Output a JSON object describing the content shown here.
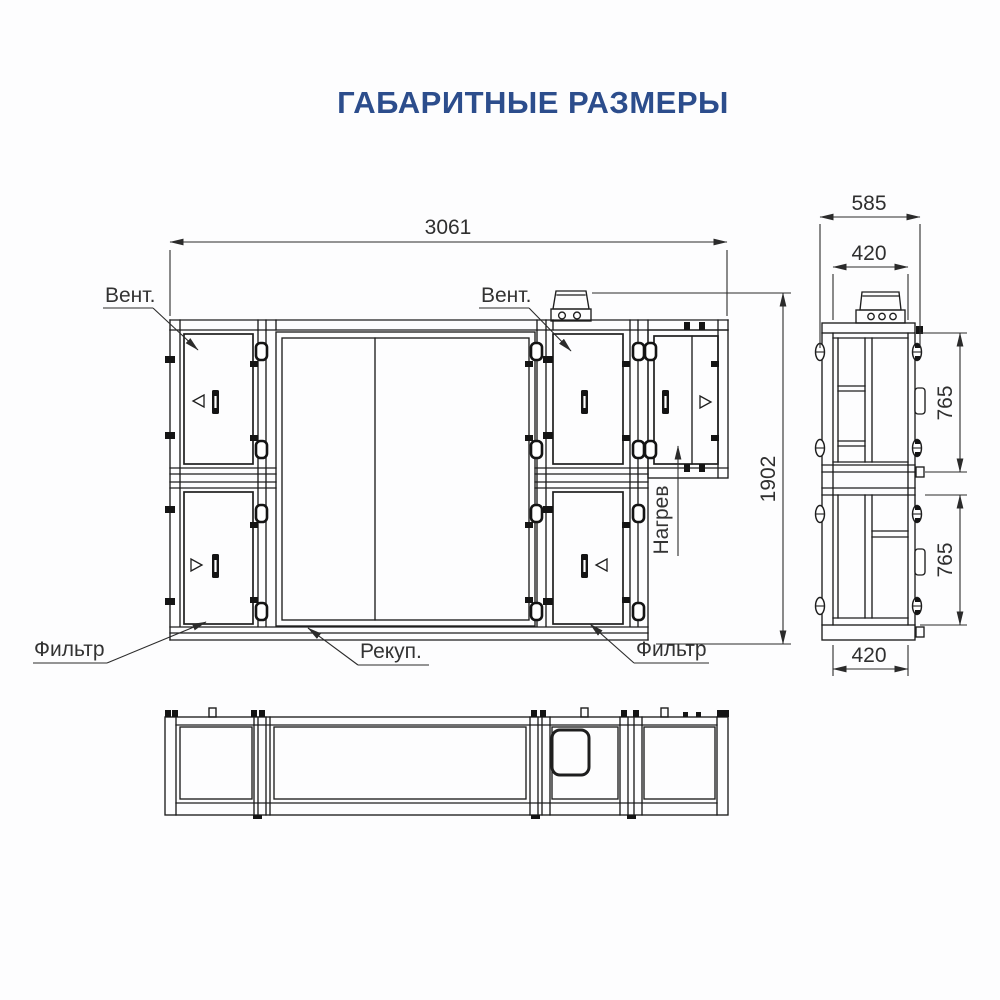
{
  "page": {
    "title": "ГАБАРИТНЫЕ РАЗМЕРЫ"
  },
  "colors": {
    "title_text": "#2c4d8c",
    "drawing_lines": "#1e1e1e",
    "dimension_text": "#2f2f2f",
    "background": "#fdfdfe"
  },
  "front_view": {
    "dim_width": "3061",
    "dim_height": "1902",
    "label_fan_left": "Вент.",
    "label_fan_right": "Вент.",
    "label_filter_left": "Фильтр",
    "label_filter_right": "Фильтр",
    "label_recuperator": "Рекуп.",
    "label_heater": "Нагрев"
  },
  "side_view": {
    "dim_depth_overall": "585",
    "dim_top_duct_width": "420",
    "dim_upper_module_height": "765",
    "dim_lower_module_height": "765",
    "dim_bottom_duct_width": "420"
  }
}
